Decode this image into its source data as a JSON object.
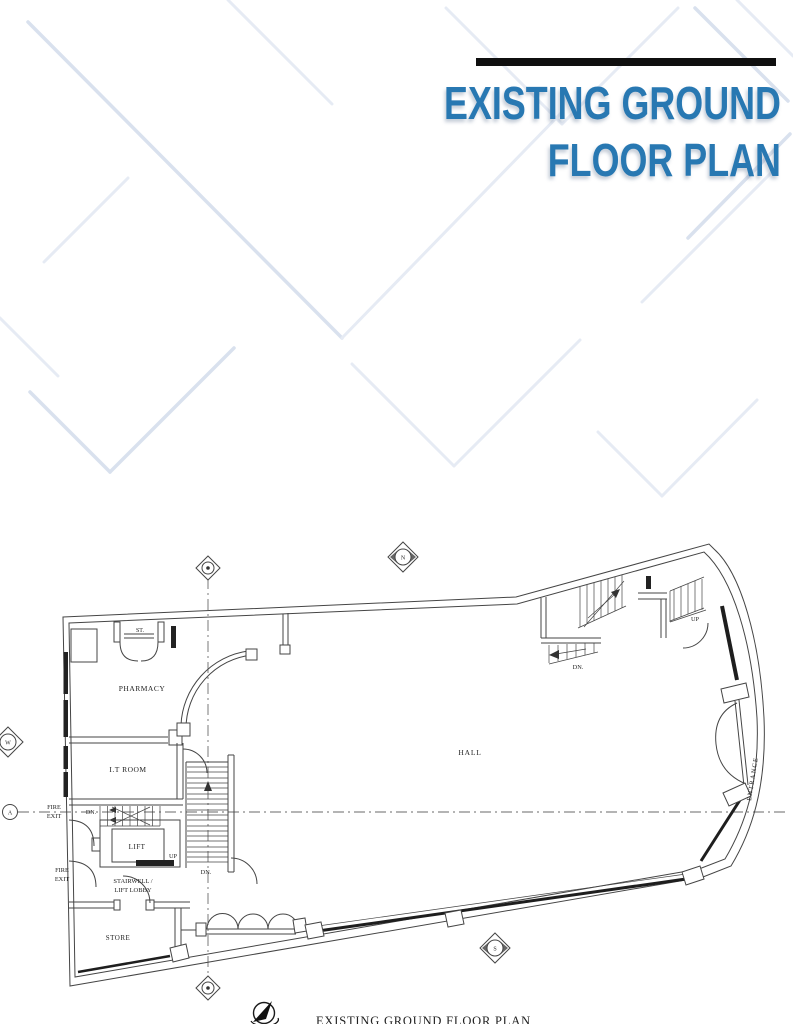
{
  "header": {
    "title_line1": "EXISTING GROUND",
    "title_line2": "FLOOR PLAN"
  },
  "plan": {
    "rooms": {
      "st": "ST.",
      "pharmacy": "PHARMACY",
      "it_room": "I.T ROOM",
      "hall": "HALL",
      "lift": "LIFT",
      "stairwell_1": "STAIRWELL /",
      "stairwell_2": "LIFT LOBBY",
      "store": "STORE",
      "entrance": "ENTRANCE"
    },
    "annotations": {
      "up": "UP",
      "dn": "DN.",
      "fire": "FIRE",
      "exit": "EXIT"
    },
    "compass": {
      "north": "N",
      "west": "W",
      "south": "S"
    },
    "grid_row": "A"
  },
  "caption": "EXISTING GROUND FLOOR PLAN",
  "colors": {
    "accent_blue": "#2878B2",
    "bar": "#0f0f0f",
    "line": "#454545",
    "pattern_light": "#E6EBF4",
    "pattern_mid": "#D9E1EE"
  }
}
